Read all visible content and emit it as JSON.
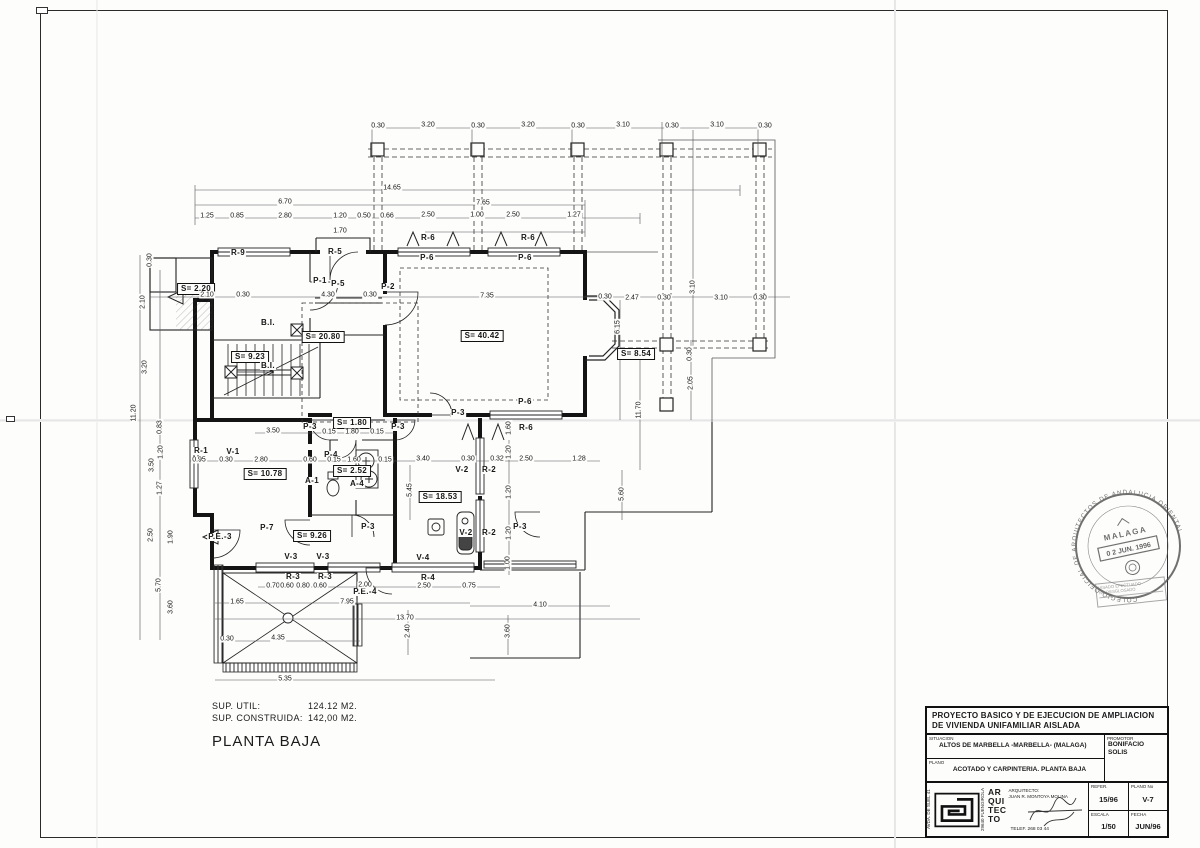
{
  "summary": {
    "sup_util_label": "SUP. UTIL:",
    "sup_util_value": "124.12 M2.",
    "sup_construida_label": "SUP. CONSTRUIDA:",
    "sup_construida_value": "142,00 M2.",
    "floor_title": "PLANTA BAJA"
  },
  "title_block": {
    "project_title": "PROYECTO BASICO Y DE EJECUCION DE AMPLIACION DE VIVIENDA UNIFAMILIAR AISLADA",
    "situacion_caption": "SITUACION",
    "situacion_value": "ALTOS DE MARBELLA -MARBELLA- (MALAGA)",
    "plano_caption": "PLANO",
    "plano_value": "ACOTADO Y CARPINTERIA. PLANTA BAJA",
    "promotor_caption": "PROMOTOR",
    "promotor_value": "BONIFACIO SOLIS",
    "address_line1": "AVDA. DE SUEL 41",
    "address_line2": "29640 FUENGIROLA",
    "arq_stack": "AR QUI TEC TO",
    "arquitecto_caption": "ARQUITECTO:",
    "arquitecto_value": "JUAN R. MONTOYA MOLINA",
    "telef": "TELEF. 268 03 44",
    "refer_caption": "REFER.",
    "refer_value": "15/96",
    "plano_no_caption": "PLANO No",
    "plano_no_value": "V-7",
    "escala_caption": "ESCALA",
    "escala_value": "1/50",
    "fecha_caption": "FECHA",
    "fecha_value": "JUN/96"
  },
  "stamp": {
    "ring_text": "COLEGIO OFICIAL DE ARQUITECTOS DE ANDALUCIA ORIENTAL",
    "city": "MALAGA",
    "date_stamp": "0 2 JUN. 1996",
    "visa_line1": "VISADO EFECTUADO",
    "visa_line2": "NO DESGLOSADO"
  },
  "plan": {
    "labels": [
      {
        "t": "S= 2.20",
        "x": 196,
        "y": 289,
        "k": "box"
      },
      {
        "t": "S= 20.80",
        "x": 323,
        "y": 337,
        "k": "box"
      },
      {
        "t": "S= 9.23",
        "x": 250,
        "y": 357,
        "k": "box"
      },
      {
        "t": "S= 40.42",
        "x": 482,
        "y": 336,
        "k": "box"
      },
      {
        "t": "S= 8.54",
        "x": 636,
        "y": 354,
        "k": "box"
      },
      {
        "t": "S= 10.78",
        "x": 265,
        "y": 474,
        "k": "box"
      },
      {
        "t": "S= 2.52",
        "x": 352,
        "y": 471,
        "k": "box"
      },
      {
        "t": "S= 1.80",
        "x": 352,
        "y": 423,
        "k": "box"
      },
      {
        "t": "S= 18.53",
        "x": 440,
        "y": 497,
        "k": "box"
      },
      {
        "t": "S= 9.26",
        "x": 312,
        "y": 536,
        "k": "box"
      },
      {
        "t": "R-9",
        "x": 238,
        "y": 253,
        "k": "tag"
      },
      {
        "t": "R-5",
        "x": 335,
        "y": 252,
        "k": "tag"
      },
      {
        "t": "P-5",
        "x": 338,
        "y": 284,
        "k": "tag"
      },
      {
        "t": "P-1",
        "x": 320,
        "y": 281,
        "k": "tag"
      },
      {
        "t": "P-2",
        "x": 388,
        "y": 287,
        "k": "tag"
      },
      {
        "t": "B.I.",
        "x": 268,
        "y": 323,
        "k": "tag"
      },
      {
        "t": "B.I.",
        "x": 268,
        "y": 366,
        "k": "tag"
      },
      {
        "t": "R-6",
        "x": 428,
        "y": 238,
        "k": "tag"
      },
      {
        "t": "R-6",
        "x": 528,
        "y": 238,
        "k": "tag"
      },
      {
        "t": "P-6",
        "x": 427,
        "y": 258,
        "k": "tag"
      },
      {
        "t": "P-6",
        "x": 525,
        "y": 258,
        "k": "tag"
      },
      {
        "t": "P-6",
        "x": 525,
        "y": 402,
        "k": "tag"
      },
      {
        "t": "P-3",
        "x": 458,
        "y": 413,
        "k": "tag"
      },
      {
        "t": "R-6",
        "x": 526,
        "y": 428,
        "k": "tag"
      },
      {
        "t": "P-3",
        "x": 310,
        "y": 427,
        "k": "tag"
      },
      {
        "t": "P-3",
        "x": 398,
        "y": 427,
        "k": "tag"
      },
      {
        "t": "R-1",
        "x": 201,
        "y": 451,
        "k": "tag"
      },
      {
        "t": "V-1",
        "x": 233,
        "y": 452,
        "k": "tag"
      },
      {
        "t": "P-4",
        "x": 331,
        "y": 455,
        "k": "tag"
      },
      {
        "t": "A-1",
        "x": 312,
        "y": 481,
        "k": "tag"
      },
      {
        "t": "A-4",
        "x": 357,
        "y": 484,
        "k": "tag"
      },
      {
        "t": "V-2",
        "x": 462,
        "y": 470,
        "k": "tag"
      },
      {
        "t": "R-2",
        "x": 489,
        "y": 470,
        "k": "tag"
      },
      {
        "t": "V-2",
        "x": 466,
        "y": 533,
        "k": "tag"
      },
      {
        "t": "R-2",
        "x": 489,
        "y": 533,
        "k": "tag"
      },
      {
        "t": "P-7",
        "x": 267,
        "y": 528,
        "k": "tag"
      },
      {
        "t": "P.E.-3",
        "x": 220,
        "y": 537,
        "k": "tag"
      },
      {
        "t": "P-3",
        "x": 368,
        "y": 527,
        "k": "tag"
      },
      {
        "t": "P-3",
        "x": 520,
        "y": 527,
        "k": "tag"
      },
      {
        "t": "V-3",
        "x": 291,
        "y": 557,
        "k": "tag"
      },
      {
        "t": "V-3",
        "x": 323,
        "y": 557,
        "k": "tag"
      },
      {
        "t": "V-4",
        "x": 423,
        "y": 558,
        "k": "tag"
      },
      {
        "t": "R-3",
        "x": 293,
        "y": 577,
        "k": "tag"
      },
      {
        "t": "R-3",
        "x": 325,
        "y": 577,
        "k": "tag"
      },
      {
        "t": "R-4",
        "x": 428,
        "y": 578,
        "k": "tag"
      },
      {
        "t": "P.E.-4",
        "x": 365,
        "y": 592,
        "k": "tag"
      },
      {
        "t": "0.30",
        "x": 378,
        "y": 126,
        "k": "dim"
      },
      {
        "t": "3.20",
        "x": 428,
        "y": 125,
        "k": "dim"
      },
      {
        "t": "0.30",
        "x": 478,
        "y": 126,
        "k": "dim"
      },
      {
        "t": "3.20",
        "x": 528,
        "y": 125,
        "k": "dim"
      },
      {
        "t": "0.30",
        "x": 578,
        "y": 126,
        "k": "dim"
      },
      {
        "t": "3.10",
        "x": 623,
        "y": 125,
        "k": "dim"
      },
      {
        "t": "0.30",
        "x": 672,
        "y": 126,
        "k": "dim"
      },
      {
        "t": "3.10",
        "x": 717,
        "y": 125,
        "k": "dim"
      },
      {
        "t": "0.30",
        "x": 765,
        "y": 126,
        "k": "dim"
      },
      {
        "t": "14.65",
        "x": 392,
        "y": 188,
        "k": "dim"
      },
      {
        "t": "6.70",
        "x": 285,
        "y": 202,
        "k": "dim"
      },
      {
        "t": "7.65",
        "x": 483,
        "y": 203,
        "k": "dim"
      },
      {
        "t": "1.25",
        "x": 207,
        "y": 216,
        "k": "dim"
      },
      {
        "t": "0.85",
        "x": 237,
        "y": 216,
        "k": "dim"
      },
      {
        "t": "2.80",
        "x": 285,
        "y": 216,
        "k": "dim"
      },
      {
        "t": "1.20",
        "x": 340,
        "y": 216,
        "k": "dim"
      },
      {
        "t": "0.50",
        "x": 364,
        "y": 216,
        "k": "dim"
      },
      {
        "t": "0.66",
        "x": 387,
        "y": 216,
        "k": "dim"
      },
      {
        "t": "2.50",
        "x": 428,
        "y": 215,
        "k": "dim"
      },
      {
        "t": "1.00",
        "x": 477,
        "y": 215,
        "k": "dim"
      },
      {
        "t": "2.50",
        "x": 513,
        "y": 215,
        "k": "dim"
      },
      {
        "t": "1.27",
        "x": 574,
        "y": 215,
        "k": "dim"
      },
      {
        "t": "1.70",
        "x": 340,
        "y": 231,
        "k": "dim"
      },
      {
        "t": "2.10",
        "x": 207,
        "y": 295,
        "k": "dim"
      },
      {
        "t": "0.30",
        "x": 243,
        "y": 295,
        "k": "dim"
      },
      {
        "t": "4.30",
        "x": 328,
        "y": 295,
        "k": "dim"
      },
      {
        "t": "0.30",
        "x": 370,
        "y": 295,
        "k": "dim"
      },
      {
        "t": "7.35",
        "x": 487,
        "y": 296,
        "k": "dim"
      },
      {
        "t": "0.30",
        "x": 605,
        "y": 297,
        "k": "dim"
      },
      {
        "t": "2.47",
        "x": 632,
        "y": 298,
        "k": "dim"
      },
      {
        "t": "0.30",
        "x": 664,
        "y": 298,
        "k": "dim"
      },
      {
        "t": "3.10",
        "x": 721,
        "y": 298,
        "k": "dim"
      },
      {
        "t": "0.30",
        "x": 760,
        "y": 298,
        "k": "dim"
      },
      {
        "t": "3.50",
        "x": 273,
        "y": 431,
        "k": "dim"
      },
      {
        "t": "0.15",
        "x": 329,
        "y": 432,
        "k": "dim"
      },
      {
        "t": "1.80",
        "x": 352,
        "y": 432,
        "k": "dim"
      },
      {
        "t": "0.15",
        "x": 377,
        "y": 432,
        "k": "dim"
      },
      {
        "t": "0.95",
        "x": 199,
        "y": 460,
        "k": "dim"
      },
      {
        "t": "0.30",
        "x": 226,
        "y": 460,
        "k": "dim"
      },
      {
        "t": "2.80",
        "x": 261,
        "y": 460,
        "k": "dim"
      },
      {
        "t": "0.60",
        "x": 310,
        "y": 460,
        "k": "dim"
      },
      {
        "t": "0.15",
        "x": 334,
        "y": 460,
        "k": "dim"
      },
      {
        "t": "1.60",
        "x": 354,
        "y": 460,
        "k": "dim"
      },
      {
        "t": "0.15",
        "x": 385,
        "y": 460,
        "k": "dim"
      },
      {
        "t": "3.40",
        "x": 423,
        "y": 459,
        "k": "dim"
      },
      {
        "t": "0.30",
        "x": 468,
        "y": 459,
        "k": "dim"
      },
      {
        "t": "0.32",
        "x": 497,
        "y": 459,
        "k": "dim"
      },
      {
        "t": "2.50",
        "x": 526,
        "y": 459,
        "k": "dim"
      },
      {
        "t": "1.28",
        "x": 579,
        "y": 459,
        "k": "dim"
      },
      {
        "t": "0.70",
        "x": 273,
        "y": 586,
        "k": "dim"
      },
      {
        "t": "0.60",
        "x": 287,
        "y": 586,
        "k": "dim"
      },
      {
        "t": "0.80",
        "x": 303,
        "y": 586,
        "k": "dim"
      },
      {
        "t": "0.60",
        "x": 320,
        "y": 586,
        "k": "dim"
      },
      {
        "t": "2.00",
        "x": 365,
        "y": 585,
        "k": "dim"
      },
      {
        "t": "2.50",
        "x": 424,
        "y": 586,
        "k": "dim"
      },
      {
        "t": "0.75",
        "x": 469,
        "y": 586,
        "k": "dim"
      },
      {
        "t": "1.65",
        "x": 237,
        "y": 602,
        "k": "dim"
      },
      {
        "t": "7.95",
        "x": 347,
        "y": 602,
        "k": "dim"
      },
      {
        "t": "13.70",
        "x": 405,
        "y": 618,
        "k": "dim"
      },
      {
        "t": "0.30",
        "x": 227,
        "y": 639,
        "k": "dim"
      },
      {
        "t": "4.35",
        "x": 278,
        "y": 638,
        "k": "dim"
      },
      {
        "t": "5.35",
        "x": 285,
        "y": 679,
        "k": "dim"
      },
      {
        "t": "4.10",
        "x": 540,
        "y": 605,
        "k": "dim"
      },
      {
        "t": "0.30",
        "x": 150,
        "y": 260,
        "k": "dim",
        "r": 1
      },
      {
        "t": "2.10",
        "x": 143,
        "y": 302,
        "k": "dim",
        "r": 1
      },
      {
        "t": "3.20",
        "x": 145,
        "y": 367,
        "k": "dim",
        "r": 1
      },
      {
        "t": "11.20",
        "x": 134,
        "y": 413,
        "k": "dim",
        "r": 1
      },
      {
        "t": "0.83",
        "x": 160,
        "y": 427,
        "k": "dim",
        "r": 1
      },
      {
        "t": "1.20",
        "x": 161,
        "y": 452,
        "k": "dim",
        "r": 1
      },
      {
        "t": "3.50",
        "x": 152,
        "y": 465,
        "k": "dim",
        "r": 1
      },
      {
        "t": "1.27",
        "x": 160,
        "y": 488,
        "k": "dim",
        "r": 1
      },
      {
        "t": "2.50",
        "x": 151,
        "y": 535,
        "k": "dim",
        "r": 1
      },
      {
        "t": "1.90",
        "x": 171,
        "y": 537,
        "k": "dim",
        "r": 1
      },
      {
        "t": "5.70",
        "x": 159,
        "y": 585,
        "k": "dim",
        "r": 1
      },
      {
        "t": "3.60",
        "x": 171,
        "y": 607,
        "k": "dim",
        "r": 1
      },
      {
        "t": "6.15",
        "x": 618,
        "y": 327,
        "k": "dim",
        "r": 1
      },
      {
        "t": "11.70",
        "x": 639,
        "y": 410,
        "k": "dim",
        "r": 1
      },
      {
        "t": "3.10",
        "x": 693,
        "y": 287,
        "k": "dim",
        "r": 1
      },
      {
        "t": "0.30",
        "x": 690,
        "y": 354,
        "k": "dim",
        "r": 1
      },
      {
        "t": "2.05",
        "x": 691,
        "y": 383,
        "k": "dim",
        "r": 1
      },
      {
        "t": "2.40",
        "x": 408,
        "y": 631,
        "k": "dim",
        "r": 1
      },
      {
        "t": "3.60",
        "x": 508,
        "y": 631,
        "k": "dim",
        "r": 1
      },
      {
        "t": "5.45",
        "x": 410,
        "y": 490,
        "k": "dim",
        "r": 1
      },
      {
        "t": "5.60",
        "x": 622,
        "y": 494,
        "k": "dim",
        "r": 1
      },
      {
        "t": "1.60",
        "x": 509,
        "y": 428,
        "k": "dim",
        "r": 1
      },
      {
        "t": "1.20",
        "x": 509,
        "y": 452,
        "k": "dim",
        "r": 1
      },
      {
        "t": "1.20",
        "x": 509,
        "y": 492,
        "k": "dim",
        "r": 1
      },
      {
        "t": "1.20",
        "x": 509,
        "y": 533,
        "k": "dim",
        "r": 1
      },
      {
        "t": "1.00",
        "x": 508,
        "y": 563,
        "k": "dim",
        "r": 1
      }
    ]
  }
}
